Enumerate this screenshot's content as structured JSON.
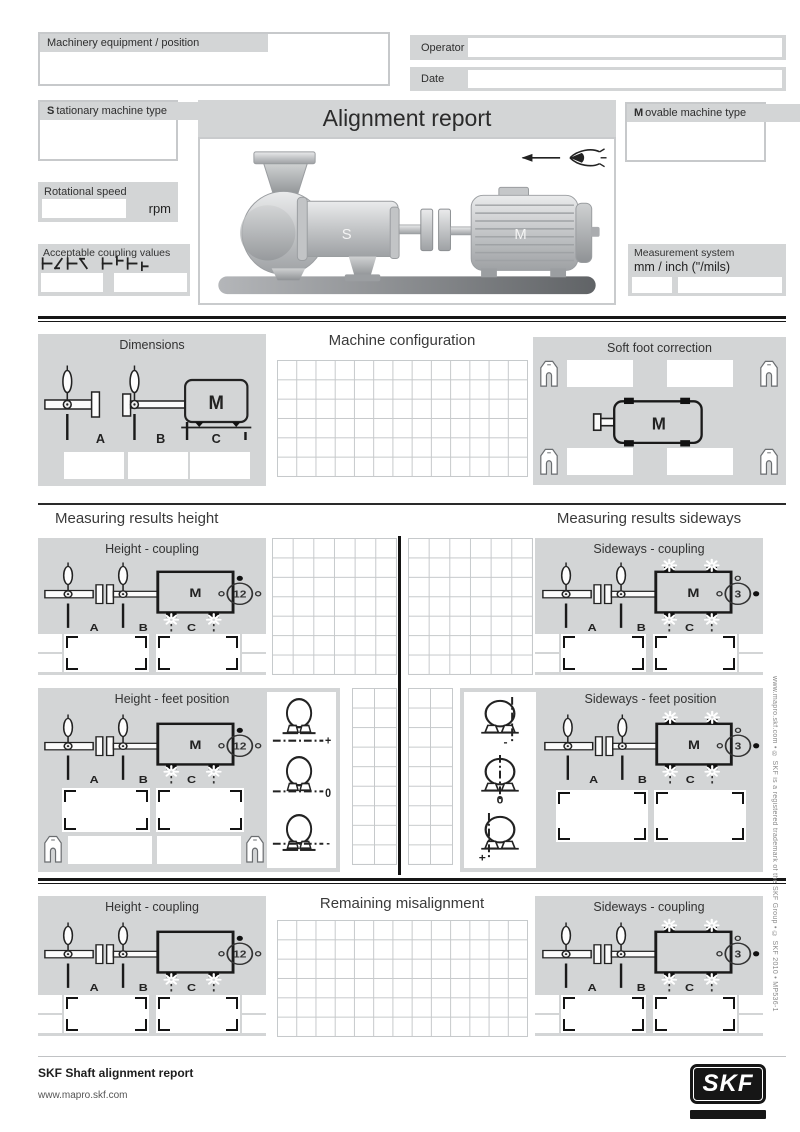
{
  "header": {
    "machinery_label": "Machinery equipment / position",
    "operator_label": "Operator",
    "date_label": "Date",
    "stationary_initial": "S",
    "stationary_rest": "tationary machine type",
    "movable_initial": "M",
    "movable_rest": "ovable machine type",
    "title": "Alignment report",
    "stationary_letter": "S",
    "movable_letter": "M",
    "rotational_label": "Rotational speed",
    "rotational_unit": "rpm",
    "coupling_label": "Acceptable coupling values",
    "measurement_label": "Measurement system",
    "measurement_units": "mm  /  inch (\"/mils)"
  },
  "config": {
    "dimensions_title": "Dimensions",
    "machine_config_title": "Machine configuration",
    "soft_foot_title": "Soft foot correction",
    "machine_letter": "M"
  },
  "measuring": {
    "height_heading": "Measuring results height",
    "sideways_heading": "Measuring results sideways",
    "height_coupling_title": "Height - coupling",
    "sideways_coupling_title": "Sideways - coupling",
    "height_feet_title": "Height - feet position",
    "sideways_feet_title": "Sideways - feet position",
    "clock_height": "12",
    "clock_sideways": "3",
    "machine_letter": "M",
    "abc": [
      "A",
      "B",
      "C"
    ],
    "height_signs": [
      "+",
      "0",
      "-"
    ],
    "sideways_signs": [
      "-",
      "0",
      "+"
    ]
  },
  "remaining": {
    "title": "Remaining misalignment",
    "height_title": "Height - coupling",
    "sideways_title": "Sideways - coupling"
  },
  "footer": {
    "product": "SKF Shaft alignment report",
    "url": "www.mapro.skf.com",
    "logo_text": "SKF",
    "side_note": "www.mapro.skf.com  •  ® SKF is a registered trademark of the SKF Group  •  © SKF 2010  •  MP536-1"
  }
}
